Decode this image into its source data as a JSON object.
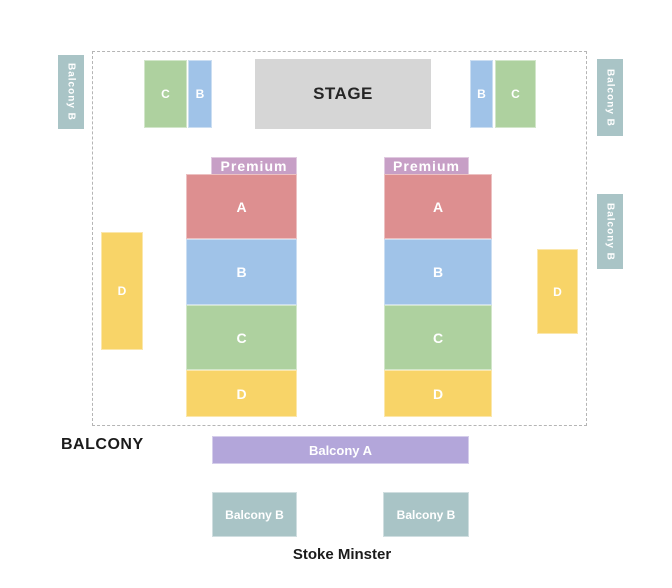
{
  "colors": {
    "section_a": "#dd8f90",
    "section_b": "#a0c3e8",
    "section_c": "#aed19f",
    "section_d": "#f8d468",
    "premium": "#c79fc6",
    "stage": "#d6d6d6",
    "balcony_a": "#b3a6da",
    "balcony_b": "#a9c4c6",
    "text_dark": "#1b1b1b"
  },
  "map": {
    "stage_label": "STAGE",
    "balcony_heading": "BALCONY",
    "venue_name": "Stoke Minster",
    "side_labels": {
      "left": "Balcony B",
      "right_top": "Balcony B",
      "right_bottom": "Balcony B"
    },
    "top_blocks": {
      "left_c": "C",
      "left_b": "B",
      "right_b": "B",
      "right_c": "C"
    },
    "side_blocks": {
      "left_d": "D",
      "right_d": "D"
    },
    "columns": {
      "left": {
        "premium": "Premium",
        "a": "A",
        "b": "B",
        "c": "C",
        "d": "D"
      },
      "right": {
        "premium": "Premium",
        "a": "A",
        "b": "B",
        "c": "C",
        "d": "D"
      }
    },
    "balcony_a": "Balcony A",
    "balcony_b_left": "Balcony B",
    "balcony_b_right": "Balcony B"
  }
}
